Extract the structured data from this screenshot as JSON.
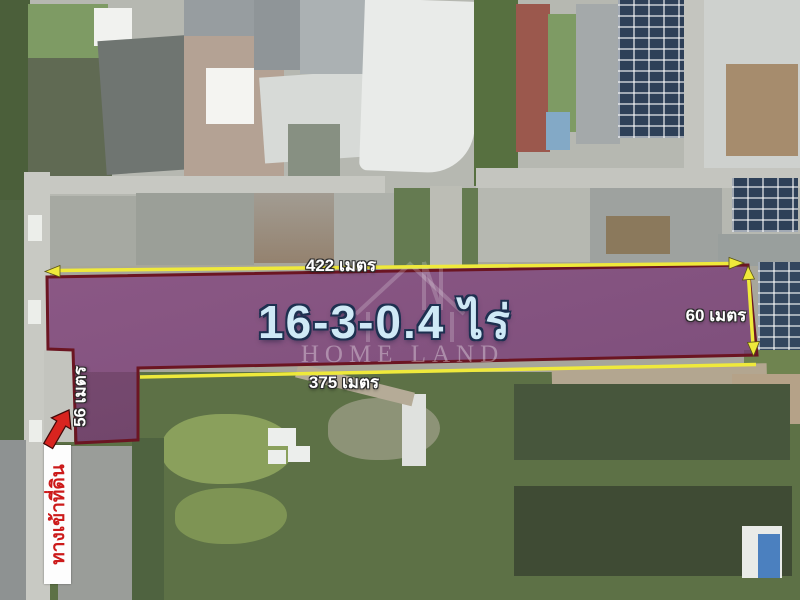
{
  "image_type": "aerial-land-plot-listing",
  "plot": {
    "area_label": "16-3-0.4 ไร่",
    "dimensions": {
      "top": "422 เมตร",
      "bottom": "375 เมตร",
      "right": "60 เมตร",
      "left": "56 เมตร"
    },
    "entrance_label": "ทางเข้าที่ดิน"
  },
  "watermark": {
    "text": "HOME LAND",
    "logo": "house-outline"
  },
  "icons": {
    "entrance_arrow": "red-arrow-up-right",
    "top_dimension": "double-headed-horizontal-arrow",
    "right_dimension": "double-headed-vertical-arrow"
  },
  "colors": {
    "plot_fill": "#7b3d78",
    "plot_border": "#6b1522",
    "dimension_yellow": "#efe93b",
    "area_text": "#cfe9f6",
    "area_text_outline": "#1d3050",
    "measurement_text": "#ffffff",
    "entrance_text": "#cc1a1a",
    "entrance_bg": "#ffffff",
    "arrow_red": "#d8241f"
  }
}
